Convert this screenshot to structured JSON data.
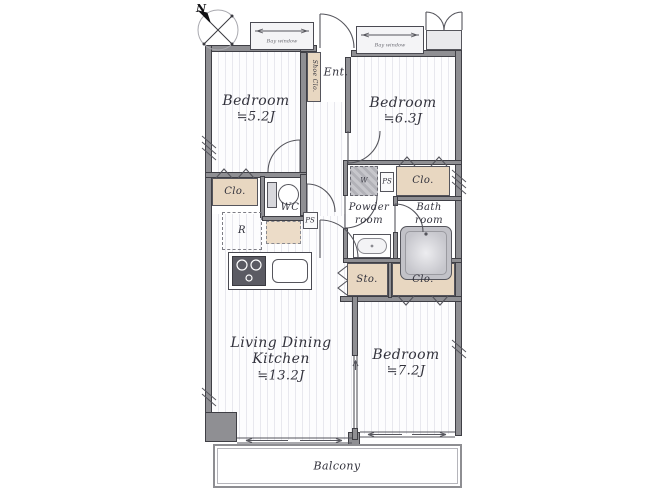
{
  "meta": {
    "type": "apartment-floor-plan"
  },
  "compass": {
    "north_label": "N"
  },
  "rooms": {
    "bedroom_nw": {
      "name": "Bedroom",
      "area": "≒5.2J"
    },
    "bedroom_ne": {
      "name": "Bedroom",
      "area": "≒6.3J"
    },
    "bedroom_se": {
      "name": "Bedroom",
      "area": "≒7.2J"
    },
    "ldk": {
      "name_line1": "Living Dining",
      "name_line2": "Kitchen",
      "area": "≒13.2J"
    },
    "entrance": {
      "label": "Ent."
    },
    "wc": {
      "label": "WC"
    },
    "powder_room": {
      "line1": "Powder",
      "line2": "room"
    },
    "bath_room": {
      "line1": "Bath",
      "line2": "room"
    },
    "balcony": {
      "label": "Balcony"
    }
  },
  "storage": {
    "shoe_closet": {
      "label": "Shoe Clo."
    },
    "closet_nw": {
      "label": "Clo."
    },
    "closet_ne": {
      "label": "Clo."
    },
    "closet_se": {
      "label": "Clo."
    },
    "storage_center": {
      "label": "Sto."
    }
  },
  "fixtures": {
    "washer": {
      "label": "W"
    },
    "pipe_space_hall": {
      "label": "PS"
    },
    "pipe_space_powder": {
      "label": "PS"
    },
    "refrigerator": {
      "label": "R"
    },
    "bay_window_nw": {
      "label": "Bay window"
    },
    "bay_window_ne": {
      "label": "Bay window"
    }
  },
  "colors": {
    "closet_fill": "#e8d7c1",
    "wall_fill": "#8f8f93",
    "wall_edge": "#3f3f45",
    "floor_stripe": "#e8e8ee",
    "fixture_gray": "#c2c2c8",
    "line": "#55555c"
  }
}
